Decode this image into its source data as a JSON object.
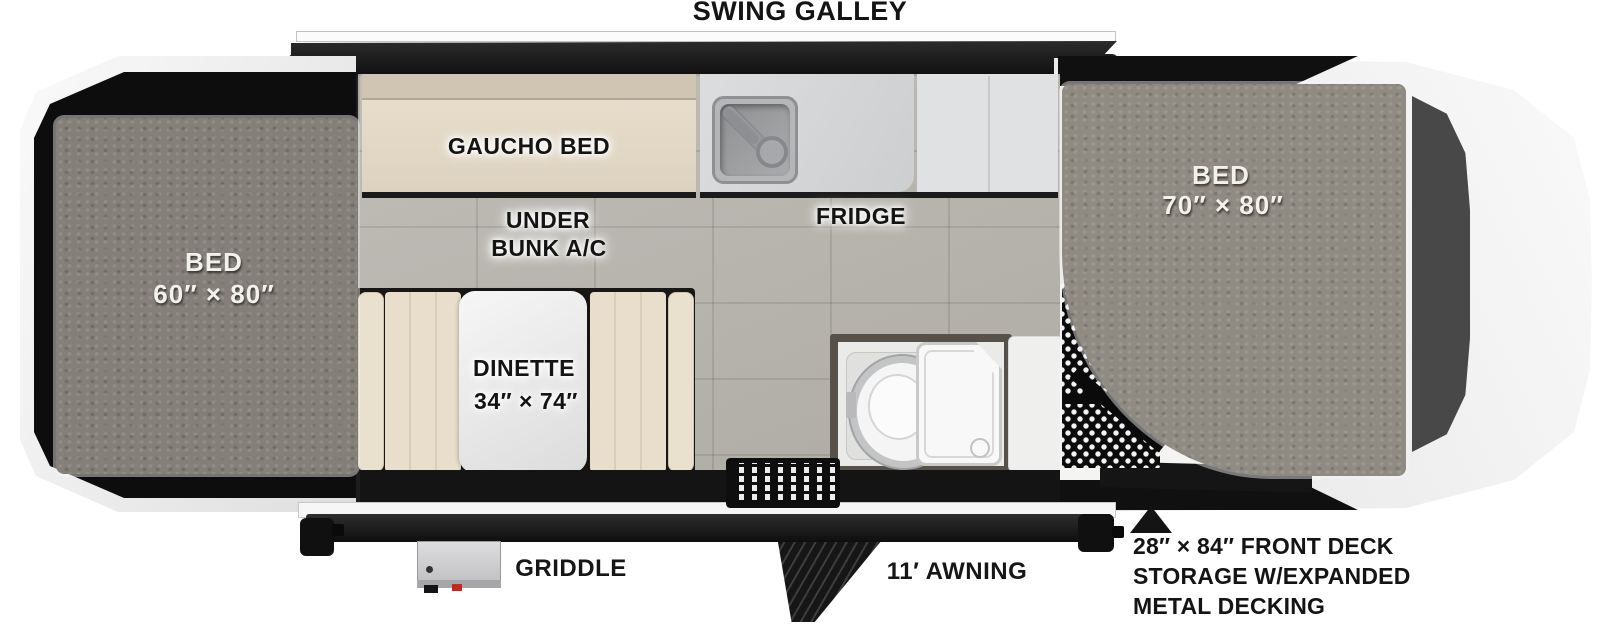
{
  "title": "SWING GALLEY",
  "labels": {
    "gaucho_bed": "GAUCHO BED",
    "under_bunk_line1": "UNDER",
    "under_bunk_line2": "BUNK A/C",
    "fridge": "FRIDGE",
    "dinette_line1": "DINETTE",
    "dinette_line2": "34″ × 74″",
    "bed_left_line1": "BED",
    "bed_left_line2": "60″ × 80″",
    "bed_right_line1": "BED",
    "bed_right_line2": "70″ × 80″",
    "griddle": "GRIDDLE",
    "awning": "11′ AWNING",
    "front_deck_line1": "28″ × 84″ FRONT DECK",
    "front_deck_line2": "STORAGE W/EXPANDED",
    "front_deck_line3": "METAL DECKING"
  },
  "colors": {
    "wall": "#1e1e1e",
    "tile_floor": "#b9b6af",
    "mattress_left": "#847f78",
    "mattress_right": "#908b82",
    "cushion_beige": "#e7ddca",
    "counter_gray": "#d5d6d8",
    "tent_frame": "#f2f2f2",
    "annotation_text": "#141414"
  }
}
